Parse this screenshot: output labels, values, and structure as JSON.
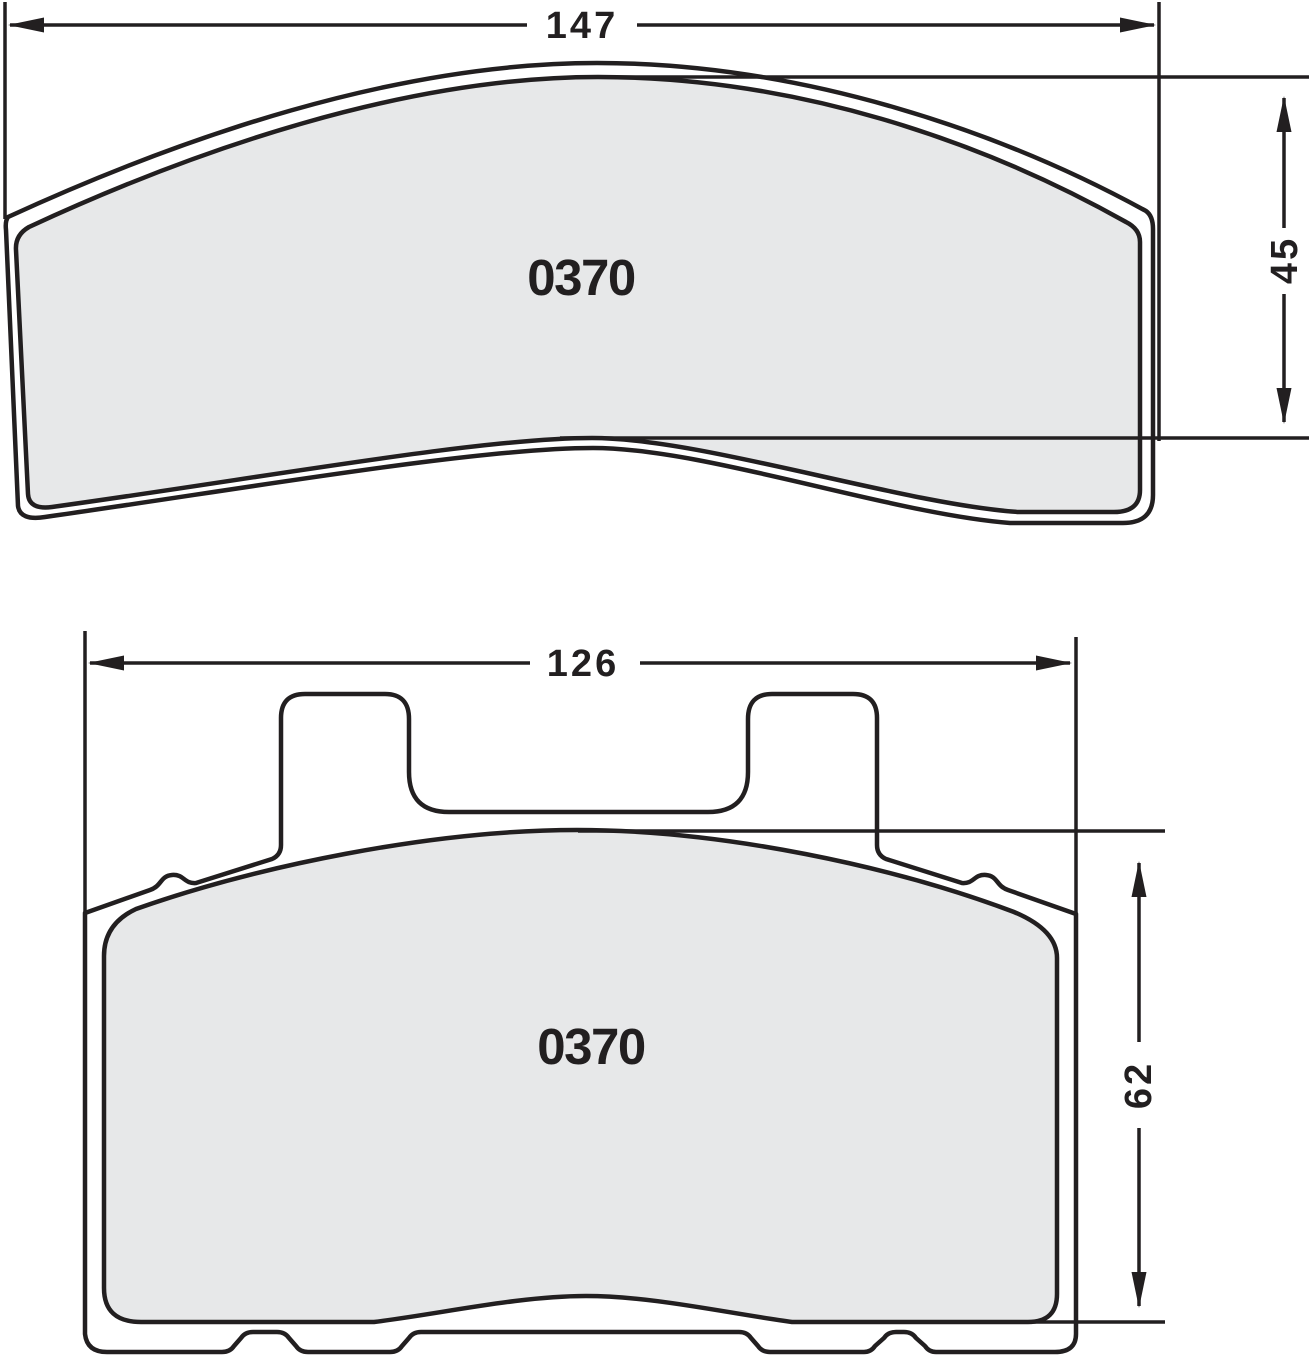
{
  "diagram": {
    "title": "brake-pad-technical-drawing",
    "part_number": "0370",
    "colors": {
      "line": "#221f20",
      "fill": "#e7e8e9",
      "background": "#ffffff"
    },
    "top_view": {
      "part_number": "0370",
      "width_label": "147",
      "height_label": "45"
    },
    "bottom_view": {
      "part_number": "0370",
      "width_label": "126",
      "height_label": "62"
    }
  }
}
